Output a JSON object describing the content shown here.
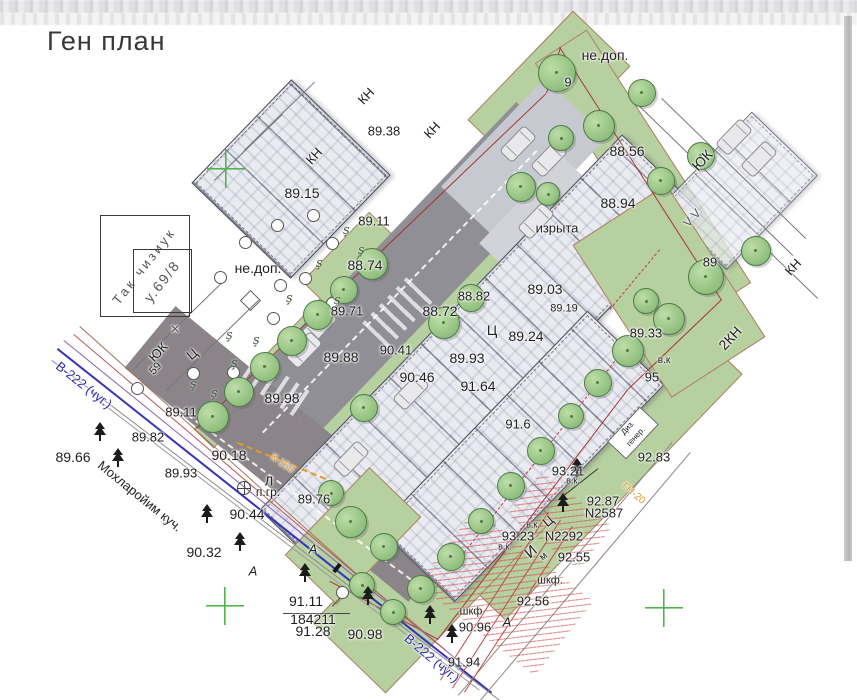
{
  "page": {
    "title": "Ген план"
  },
  "colors": {
    "lawn": "#b7d0a0",
    "road": "#8f8f95",
    "street": "#8b8589",
    "boundary": "#a83434",
    "water_main": "#2b2bb4",
    "gas": "#df9b25",
    "grid_cross": "#52b547"
  },
  "plan": {
    "labels": [
      {
        "t": "не.доп.",
        "x": 605,
        "y": 55,
        "s": 14
      },
      {
        "t": "9",
        "x": 568,
        "y": 82
      },
      {
        "t": "КН",
        "x": 366,
        "y": 96,
        "r": -47
      },
      {
        "t": "КН",
        "x": 432,
        "y": 130,
        "r": -47
      },
      {
        "t": "КН",
        "x": 314,
        "y": 156,
        "r": -47
      },
      {
        "t": "89.38",
        "x": 384,
        "y": 131
      },
      {
        "t": "89.15",
        "x": 302,
        "y": 193,
        "s": 14
      },
      {
        "t": "не.доп.",
        "x": 258,
        "y": 268,
        "s": 14
      },
      {
        "t": "88.74",
        "x": 365,
        "y": 265,
        "s": 14
      },
      {
        "t": "89.71",
        "x": 347,
        "y": 311
      },
      {
        "t": "88.72",
        "x": 440,
        "y": 311,
        "s": 14
      },
      {
        "t": "88.82",
        "x": 474,
        "y": 296
      },
      {
        "t": "89.03",
        "x": 545,
        "y": 289,
        "s": 14
      },
      {
        "t": "изрыта",
        "x": 557,
        "y": 228
      },
      {
        "t": "88.56",
        "x": 627,
        "y": 151,
        "s": 14
      },
      {
        "t": "88.94",
        "x": 618,
        "y": 203,
        "s": 14
      },
      {
        "t": "ЮК",
        "x": 702,
        "y": 160,
        "r": -47,
        "s": 14
      },
      {
        "t": "89",
        "x": 710,
        "y": 262
      },
      {
        "t": "КН",
        "x": 793,
        "y": 267,
        "r": -47
      },
      {
        "t": "2КН",
        "x": 730,
        "y": 338,
        "r": -47,
        "s": 14
      },
      {
        "t": "89.33",
        "x": 646,
        "y": 333
      },
      {
        "t": "в.к",
        "x": 664,
        "y": 361,
        "s": 10
      },
      {
        "t": "95",
        "x": 652,
        "y": 377
      },
      {
        "t": "89.24",
        "x": 526,
        "y": 336,
        "s": 14
      },
      {
        "t": "Ц",
        "x": 492,
        "y": 330,
        "s": 14
      },
      {
        "t": "89.93",
        "x": 467,
        "y": 358,
        "s": 14
      },
      {
        "t": "91.64",
        "x": 478,
        "y": 386,
        "s": 14
      },
      {
        "t": "90.46",
        "x": 417,
        "y": 377,
        "s": 14
      },
      {
        "t": "89.19",
        "x": 564,
        "y": 309,
        "s": 11
      },
      {
        "t": "90.41",
        "x": 396,
        "y": 350
      },
      {
        "t": "89.88",
        "x": 341,
        "y": 357,
        "s": 14
      },
      {
        "t": "91.6",
        "x": 518,
        "y": 424
      },
      {
        "t": "89.11",
        "x": 374,
        "y": 221
      },
      {
        "t": "ЮК",
        "x": 158,
        "y": 352,
        "r": -47
      },
      {
        "t": "Ц",
        "x": 192,
        "y": 354,
        "r": -40
      },
      {
        "t": "59",
        "x": 156,
        "y": 369,
        "r": -47,
        "s": 11
      },
      {
        "t": "В-222 (чуг.)",
        "x": 84,
        "y": 385,
        "r": 38,
        "c": "#2b2bb4"
      },
      {
        "t": "89.82",
        "x": 148,
        "y": 437
      },
      {
        "t": "89.66",
        "x": 73,
        "y": 457,
        "s": 14
      },
      {
        "t": "Мохларойим куч.",
        "x": 140,
        "y": 496,
        "r": 39
      },
      {
        "t": "89.93",
        "x": 181,
        "y": 473
      },
      {
        "t": "89.11",
        "x": 181,
        "y": 412
      },
      {
        "t": "90.18",
        "x": 229,
        "y": 455,
        "s": 14
      },
      {
        "t": "89.98",
        "x": 282,
        "y": 398,
        "s": 14
      },
      {
        "t": "90.44",
        "x": 247,
        "y": 514,
        "s": 14
      },
      {
        "t": "К-150",
        "x": 282,
        "y": 464,
        "r": 34,
        "c": "#df9b25",
        "s": 10
      },
      {
        "t": "Л",
        "x": 269,
        "y": 481
      },
      {
        "t": "п.гр.",
        "x": 268,
        "y": 492,
        "s": 12
      },
      {
        "t": "89.76",
        "x": 314,
        "y": 499
      },
      {
        "t": "90.32",
        "x": 204,
        "y": 552,
        "s": 14
      },
      {
        "t": "А",
        "x": 253,
        "y": 571,
        "i": 1
      },
      {
        "t": "А",
        "x": 313,
        "y": 549,
        "i": 1
      },
      {
        "t": "А",
        "x": 507,
        "y": 622,
        "i": 1
      },
      {
        "t": "91.11",
        "x": 306,
        "y": 601,
        "s": 14
      },
      {
        "t": "184211",
        "x": 313,
        "y": 619,
        "s": 14
      },
      {
        "t": "91.28",
        "x": 313,
        "y": 631,
        "s": 14
      },
      {
        "t": "90.98",
        "x": 365,
        "y": 634,
        "s": 14
      },
      {
        "t": "В-222 (чуг.)",
        "x": 432,
        "y": 658,
        "r": 40,
        "c": "#2b2bb4"
      },
      {
        "t": "91.94",
        "x": 464,
        "y": 662
      },
      {
        "t": "90.96",
        "x": 475,
        "y": 627
      },
      {
        "t": "шкф",
        "x": 471,
        "y": 612,
        "s": 11
      },
      {
        "t": "92.56",
        "x": 533,
        "y": 601
      },
      {
        "t": "шкф.",
        "x": 550,
        "y": 581,
        "s": 11
      },
      {
        "t": "92.55",
        "x": 574,
        "y": 557
      },
      {
        "t": "N2292",
        "x": 564,
        "y": 536
      },
      {
        "t": "93.23",
        "x": 518,
        "y": 536
      },
      {
        "t": "в.к.",
        "x": 533,
        "y": 525,
        "s": 9
      },
      {
        "t": "в.к.",
        "x": 505,
        "y": 547,
        "s": 9
      },
      {
        "t": "И",
        "x": 531,
        "y": 552,
        "r": -40,
        "s": 15
      },
      {
        "t": "м",
        "x": 544,
        "y": 557,
        "r": -40,
        "s": 10
      },
      {
        "t": "Ц",
        "x": 548,
        "y": 521,
        "r": -40
      },
      {
        "t": "93.21",
        "x": 568,
        "y": 471
      },
      {
        "t": "в.к.",
        "x": 573,
        "y": 481,
        "s": 9
      },
      {
        "t": "92.87",
        "x": 603,
        "y": 501
      },
      {
        "t": "N2587",
        "x": 604,
        "y": 513
      },
      {
        "t": "ГН-20",
        "x": 633,
        "y": 494,
        "r": 40,
        "c": "#df9b25",
        "s": 10
      },
      {
        "t": "92.83",
        "x": 654,
        "y": 457
      },
      {
        "t": "Диз.",
        "x": 628,
        "y": 428,
        "r": -47,
        "s": 8
      },
      {
        "t": "генер.",
        "x": 636,
        "y": 437,
        "r": -47,
        "s": 8
      },
      {
        "t": "V  V",
        "x": 692,
        "y": 218,
        "r": -47,
        "s": 12,
        "c": "#555"
      },
      {
        "t": "Так чизиук",
        "x": 144,
        "y": 266,
        "r": -52,
        "c": "#555",
        "ls": 3
      },
      {
        "t": "у.69/8",
        "x": 162,
        "y": 281,
        "r": -52,
        "c": "#555",
        "s": 14,
        "ls": 2
      },
      {
        "t": "×",
        "x": 175,
        "y": 330,
        "s": 16,
        "c": "#555"
      }
    ],
    "greens": [
      {
        "x": 548,
        "y": 92,
        "w": 150,
        "h": 78,
        "r": -46
      },
      {
        "x": 642,
        "y": 172,
        "w": 300,
        "h": 60,
        "r": 57
      },
      {
        "x": 588,
        "y": 462,
        "w": 340,
        "h": 95,
        "r": -46
      },
      {
        "x": 432,
        "y": 570,
        "w": 240,
        "h": 100,
        "r": -46
      },
      {
        "x": 297,
        "y": 340,
        "w": 270,
        "h": 26,
        "r": -46
      },
      {
        "x": 430,
        "y": 323,
        "w": 340,
        "h": 14,
        "r": -46
      },
      {
        "x": 352,
        "y": 263,
        "w": 95,
        "h": 48,
        "r": -46
      }
    ],
    "greens2": [
      {
        "x": 352,
        "y": 535,
        "w": 120,
        "h": 70,
        "r": -46
      },
      {
        "x": 668,
        "y": 290,
        "w": 180,
        "h": 110,
        "r": 57
      }
    ],
    "roads": [
      {
        "x": 396,
        "y": 290,
        "w": 438,
        "h": 86,
        "r": -46.3,
        "f": "#8f8f95"
      },
      {
        "x": 292,
        "y": 454,
        "w": 368,
        "h": 80,
        "r": 39.5,
        "f": "#8b8589"
      },
      {
        "x": 524,
        "y": 162,
        "w": 150,
        "h": 86,
        "r": -46.3,
        "f": "#c7c9d0"
      },
      {
        "x": 546,
        "y": 224,
        "w": 120,
        "h": 70,
        "r": -46.3,
        "f": "#d2d3d8"
      },
      {
        "x": 365,
        "y": 470,
        "w": 120,
        "h": 90,
        "r": -46,
        "f": "#dcdde1"
      }
    ],
    "patterns": [
      {
        "x": 398,
        "y": 312,
        "w": 66,
        "h": 36,
        "r": -46
      },
      {
        "x": 278,
        "y": 388,
        "w": 72,
        "h": 30,
        "r": 34
      }
    ],
    "buildings": [
      {
        "x": 290,
        "y": 178,
        "w": 142,
        "h": 136,
        "r": -46
      },
      {
        "x": 480,
        "y": 360,
        "w": 520,
        "h": 110,
        "r": -46
      },
      {
        "x": 520,
        "y": 455,
        "w": 300,
        "h": 105,
        "r": -46
      },
      {
        "x": 738,
        "y": 190,
        "w": 130,
        "h": 90,
        "r": -46,
        "faint": 1
      }
    ],
    "boxes": [
      {
        "x": 632,
        "y": 432,
        "w": 46,
        "h": 24,
        "r": -47
      }
    ],
    "lines": [
      [
        196,
        428,
        546,
        93,
        "#a83434",
        1.6,
        0
      ],
      [
        546,
        93,
        560,
        47,
        "#a83434",
        1.6,
        0
      ],
      [
        560,
        47,
        722,
        300,
        "#a83434",
        1.6,
        0
      ],
      [
        722,
        300,
        628,
        390,
        "#a83434",
        1.6,
        0
      ],
      [
        628,
        390,
        438,
        640,
        "#a83434",
        1.6,
        0
      ],
      [
        438,
        640,
        330,
        582,
        "#a83434",
        1.6,
        0
      ],
      [
        640,
        330,
        455,
        565,
        "#c04040",
        1.3,
        1
      ],
      [
        660,
        250,
        610,
        310,
        "#c04040",
        1.3,
        1
      ],
      [
        58,
        348,
        492,
        692,
        "#3434be",
        2,
        0
      ],
      [
        64,
        340,
        468,
        668,
        "#8a5fae",
        1.4,
        0
      ],
      [
        74,
        334,
        446,
        650,
        "#bf5555",
        1.2,
        0
      ],
      [
        52,
        360,
        500,
        700,
        "#8a8a8a",
        1,
        0
      ],
      [
        80,
        326,
        420,
        630,
        "#a0705a",
        1.2,
        0
      ],
      [
        96,
        398,
        480,
        690,
        "#999999",
        1,
        0
      ],
      [
        640,
        106,
        793,
        255,
        "#777777",
        1,
        0
      ],
      [
        662,
        98,
        806,
        238,
        "#777777",
        1,
        0
      ],
      [
        762,
        244,
        818,
        298,
        "#777777",
        1,
        0
      ],
      [
        132,
        370,
        224,
        280,
        "#777777",
        1,
        0
      ],
      [
        166,
        390,
        258,
        300,
        "#777777",
        1,
        0
      ],
      [
        244,
        150,
        314,
        82,
        "#777777",
        1,
        0
      ],
      [
        214,
        180,
        282,
        114,
        "#777777",
        1,
        0
      ],
      [
        458,
        695,
        672,
        442,
        "#888888",
        1,
        0
      ],
      [
        480,
        700,
        690,
        452,
        "#888888",
        1,
        0
      ],
      [
        560,
        498,
        598,
        468,
        "#333333",
        1,
        0
      ],
      [
        283,
        613,
        350,
        613,
        "#444444",
        1,
        0
      ],
      [
        332,
        606,
        344,
        593,
        "#444444",
        1,
        0
      ],
      [
        262,
        432,
        536,
        150,
        "rgba(255,255,255,.85)",
        2,
        1
      ],
      [
        180,
        408,
        420,
        585,
        "rgba(255,255,255,.85)",
        2,
        1
      ],
      [
        238,
        442,
        326,
        478,
        "#df9b25",
        2,
        1
      ],
      [
        452,
        688,
        560,
        520,
        "#c04848",
        1,
        0
      ],
      [
        464,
        692,
        572,
        526,
        "#c04848",
        1,
        0
      ],
      [
        440,
        680,
        548,
        512,
        "#c04848",
        1,
        0
      ]
    ],
    "hatches": [
      {
        "x": 505,
        "y": 592,
        "w": 150,
        "h": 95,
        "r": 38
      },
      {
        "x": 560,
        "y": 520,
        "w": 90,
        "h": 55,
        "r": 38
      }
    ],
    "trees": [
      [
        212,
        416,
        30
      ],
      [
        238,
        391,
        28
      ],
      [
        264,
        366,
        28
      ],
      [
        291,
        340,
        28
      ],
      [
        317,
        314,
        28
      ],
      [
        343,
        289,
        26
      ],
      [
        371,
        263,
        30
      ],
      [
        443,
        322,
        30
      ],
      [
        470,
        297,
        26
      ],
      [
        363,
        407,
        26
      ],
      [
        350,
        521,
        30
      ],
      [
        383,
        546,
        26
      ],
      [
        330,
        492,
        24
      ],
      [
        556,
        72,
        36
      ],
      [
        598,
        125,
        30
      ],
      [
        641,
        92,
        26
      ],
      [
        560,
        137,
        24
      ],
      [
        520,
        186,
        28
      ],
      [
        547,
        193,
        22
      ],
      [
        660,
        180,
        26
      ],
      [
        700,
        155,
        26
      ],
      [
        755,
        250,
        28
      ],
      [
        705,
        276,
        34
      ],
      [
        668,
        318,
        30
      ],
      [
        645,
        300,
        24
      ],
      [
        627,
        350,
        30
      ],
      [
        597,
        382,
        26
      ],
      [
        570,
        415,
        24
      ],
      [
        540,
        450,
        26
      ],
      [
        510,
        485,
        26
      ],
      [
        480,
        520,
        24
      ],
      [
        450,
        556,
        26
      ],
      [
        420,
        588,
        26
      ],
      [
        392,
        611,
        24
      ],
      [
        361,
        584,
        24
      ]
    ],
    "conifers": [
      [
        100,
        432
      ],
      [
        118,
        458
      ],
      [
        207,
        514
      ],
      [
        240,
        542
      ],
      [
        305,
        573
      ],
      [
        368,
        596
      ],
      [
        430,
        615
      ],
      [
        452,
        634
      ],
      [
        577,
        468
      ],
      [
        563,
        503
      ]
    ],
    "bushes": [
      [
        320,
        263
      ],
      [
        290,
        298
      ],
      [
        230,
        335
      ],
      [
        257,
        340
      ],
      [
        235,
        363
      ],
      [
        194,
        384
      ],
      [
        215,
        393
      ],
      [
        347,
        230
      ],
      [
        362,
        250
      ],
      [
        338,
        300
      ]
    ],
    "circles": [
      [
        313,
        215
      ],
      [
        277,
        225
      ],
      [
        245,
        242
      ],
      [
        332,
        243
      ],
      [
        220,
        277
      ],
      [
        280,
        285
      ],
      [
        305,
        278
      ],
      [
        273,
        318
      ],
      [
        332,
        303
      ],
      [
        193,
        373
      ],
      [
        137,
        388
      ],
      [
        233,
        372
      ]
    ],
    "cars": [
      [
        517,
        143
      ],
      [
        548,
        158
      ],
      [
        535,
        220
      ],
      [
        733,
        136
      ],
      [
        758,
        158
      ],
      [
        410,
        391
      ],
      [
        350,
        458
      ],
      [
        318,
        325
      ],
      [
        303,
        349
      ]
    ],
    "crosses": [
      [
        226,
        169
      ],
      [
        225,
        606
      ],
      [
        664,
        608
      ]
    ],
    "markers": {
      "plus": [
        243,
        487
      ],
      "circle": [
        342,
        592
      ],
      "diamond": [
        250,
        300
      ],
      "posts": [
        [
          337,
          568
        ]
      ]
    },
    "stamp": {
      "outer": [
        100,
        215,
        88,
        100
      ],
      "inner": [
        133,
        249,
        57,
        62
      ]
    }
  }
}
